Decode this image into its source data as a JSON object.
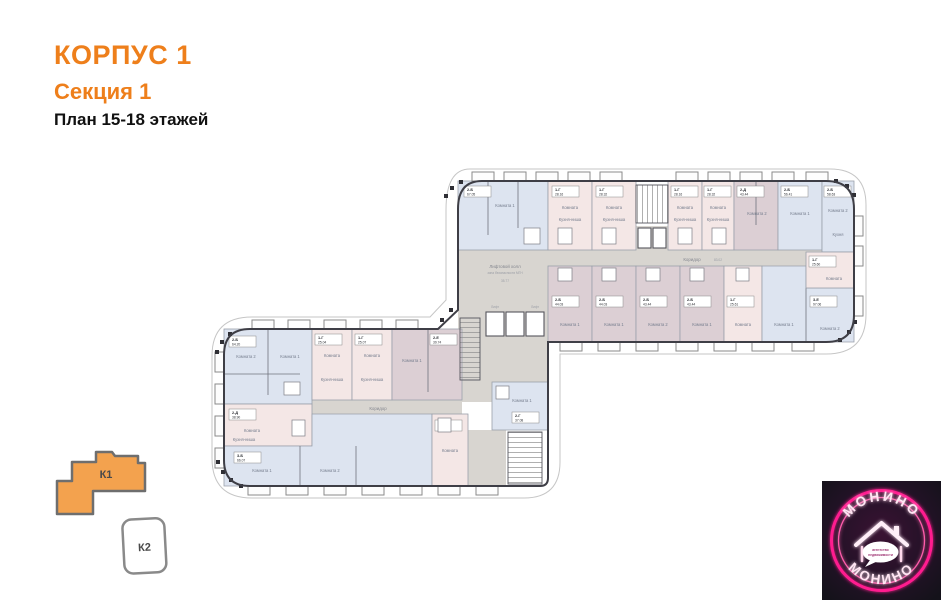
{
  "header": {
    "building": "КОРПУС 1",
    "section": "Секция 1",
    "plan_title": "План 15-18 этажей",
    "accent_color": "#ee7f1b"
  },
  "minimap": {
    "k1_label": "К1",
    "k2_label": "К2",
    "k1_color": "#f3a24e"
  },
  "plan": {
    "colors": {
      "blue": "#dde4f0",
      "pink": "#f4e7e6",
      "mauve": "#dccfd4",
      "corridor": "#d8d5d0",
      "wall": "#3e3e46"
    },
    "labels": {
      "corridor": "Коридор",
      "corridor_area": "83.02",
      "lobby": "Лифтовой холл",
      "lobby_note": "зона безопасности МГН",
      "lobby_area": "35.77",
      "lift": "Лифт"
    },
    "apartments": [
      {
        "t": "2-Б",
        "a": "67.05",
        "r": "Комната 1",
        "r2": "Кухня"
      },
      {
        "t": "1-Г",
        "a": "28.16",
        "r": "Комната",
        "r2": "Кухня-ниша"
      },
      {
        "t": "1-Г",
        "a": "28.32",
        "r": "Комната",
        "r2": "Кухня-ниша"
      },
      {
        "t": "1-Г",
        "a": "28.16",
        "r": "Комната",
        "r2": "Кухня-ниша"
      },
      {
        "t": "1-Г",
        "a": "28.32",
        "r": "Комната",
        "r2": "Кухня-ниша"
      },
      {
        "t": "2-Д",
        "a": "43.44",
        "r": "Комната 2"
      },
      {
        "t": "2-Б",
        "a": "56.41",
        "r": "Комната 1"
      },
      {
        "t": "2-Б",
        "a": "58.63",
        "r": "Комната 2",
        "r2": "Кухня"
      },
      {
        "t": "2-Б",
        "a": "44.03",
        "r": "Комната 1"
      },
      {
        "t": "2-Б",
        "a": "44.03",
        "r": "Комната 1"
      },
      {
        "t": "2-Б",
        "a": "43.44",
        "r": "Комната 2"
      },
      {
        "t": "2-Б",
        "a": "43.44",
        "r": "Комната 1"
      },
      {
        "t": "1-Г",
        "a": "25.61",
        "r": "Комната",
        "r2": "Кухня-ниша"
      },
      {
        "t": "3-Е",
        "a": "97.06",
        "r": "Комната 1",
        "r2": "Комната 2"
      },
      {
        "t": "1-Г",
        "a": "25.60",
        "r": "Комната"
      },
      {
        "t": "2-Б",
        "a": "64.20",
        "r": "Комната 2",
        "r2": "Комната 1"
      },
      {
        "t": "1-Г",
        "a": "25.04",
        "r": "Комната",
        "r2": "Кухня-ниша"
      },
      {
        "t": "1-Г",
        "a": "25.07",
        "r": "Комната",
        "r2": "Кухня-ниша"
      },
      {
        "t": "2-Е",
        "a": "39.74",
        "r": "Комната 1"
      },
      {
        "t": "2-Д",
        "a": "38.90",
        "r": "Комната",
        "r2": "Кухня-ниша"
      },
      {
        "t": "3-Б",
        "a": "66.07",
        "r": "Комната 1",
        "r2": "Комната 2"
      },
      {
        "t": "1-В",
        "a": "35.07",
        "r": "Комната"
      },
      {
        "t": "2-Г",
        "a": "37.08",
        "r": "Комната 1"
      }
    ]
  },
  "logo": {
    "brand_top": "МОНИНО",
    "brand_bottom": "МОНИНО",
    "tagline_line1": "агентство",
    "tagline_line2": "недвижимости",
    "neon_color": "#ff1f8f"
  }
}
